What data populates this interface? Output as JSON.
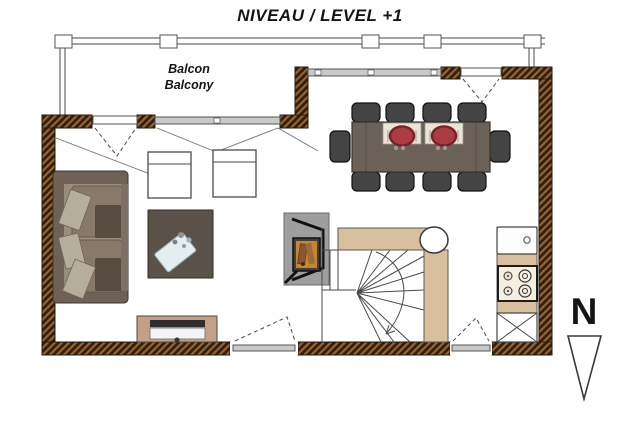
{
  "title": "NIVEAU / LEVEL +1",
  "labels": {
    "balcony_fr": "Balcon",
    "balcony_en": "Balcony",
    "north": "N"
  },
  "plan": {
    "level": "+1",
    "rooms": [
      "balcony",
      "living-room",
      "dining-area",
      "kitchen",
      "winder-staircase"
    ],
    "furniture_icons": [
      "sofa",
      "armchair",
      "armchair",
      "coffee-table",
      "tv-stand",
      "dining-table",
      "dining-chair-x10",
      "place-setting-x2",
      "wood-stove",
      "stair-column",
      "kitchen-sink",
      "cooktop-4-burners",
      "crossed-appliance",
      "balcony-railing",
      "french-window",
      "window",
      "door",
      "north-arrow"
    ]
  },
  "colors": {
    "background": "#ffffff",
    "wall_dark": "#2e2013",
    "wall_hatch": "#9c6428",
    "tan": "#d8bf9d",
    "line": "#4a4a4a",
    "furniture_dark": "#6b6159",
    "sofa_body": "#6e6256",
    "sofa_seat": "#9a8d7c",
    "pillow": "#b6ae9d",
    "chair": "#454444",
    "plate_red": "#ad3b42",
    "placemat": "#eae4d4",
    "window_gray": "#c9c9c9",
    "fireplace_gray": "#9e9e9e",
    "fire_orange": "#c8852c",
    "glass_blue": "#e3eef0"
  }
}
